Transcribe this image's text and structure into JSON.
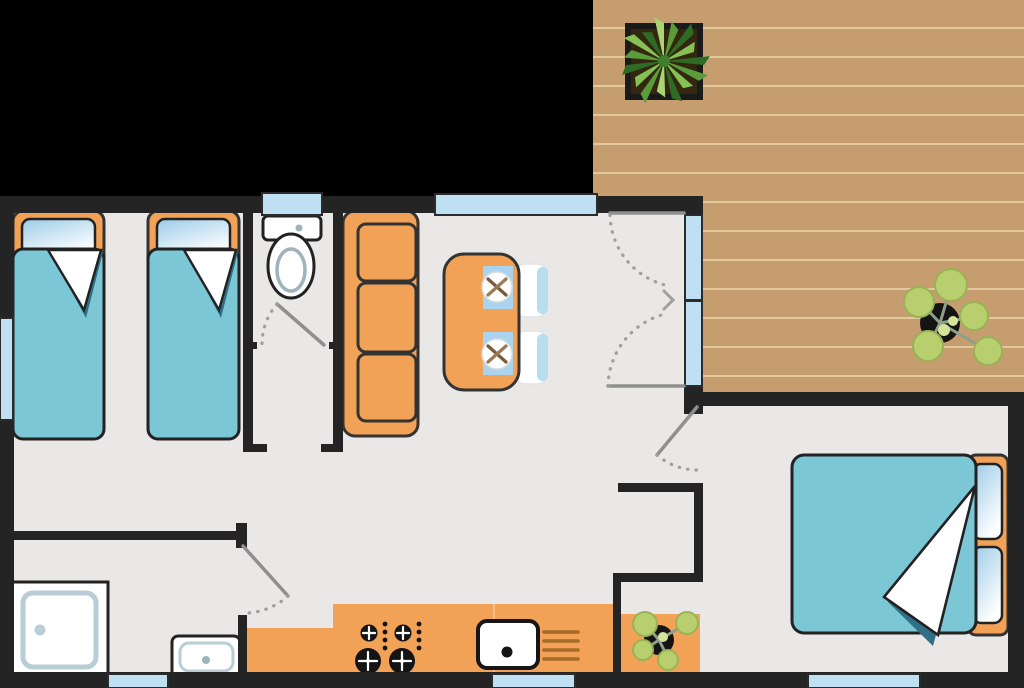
{
  "scene": {
    "type": "floor-plan",
    "title": "Mobile home floor plan with wooden deck, top-down view",
    "view": "top-down 2D architectural plan, no text labels visible"
  },
  "colors": {
    "bg": "#000000",
    "wall": "#242424",
    "floor": "#e9e8e6",
    "deck": "#c69d6e",
    "deck_line": "#e3c99e",
    "accent_orange": "#f1a257",
    "textile_teal": "#7cc7d6",
    "teal_shadow": "#2f7086",
    "window_blue": "#bfe0f3",
    "placemat_blue": "#a9d3ee",
    "chair_blue": "#b8dcf0",
    "fixture_gray": "#b9cdd6",
    "door_line": "#8f8f8f",
    "leaf_green": "#b7cf6e",
    "pot_dark": "#141414",
    "rack_brown": "#a56b28"
  },
  "rooms": [
    {
      "id": "twin-bedroom",
      "label": "Twin bedroom",
      "position": "left",
      "furniture": [
        "single bed x2 with teal blanket and folded corner",
        "side window"
      ]
    },
    {
      "id": "wc",
      "label": "WC",
      "position": "top middle-left",
      "furniture": [
        "toilet",
        "small top window",
        "hinged door"
      ]
    },
    {
      "id": "shower-room",
      "label": "Shower room",
      "position": "bottom left",
      "furniture": [
        "shower tray",
        "washbasin",
        "bottom window",
        "hinged door"
      ]
    },
    {
      "id": "living-dining",
      "label": "Living / dining room",
      "position": "center",
      "furniture": [
        "3-seat orange sofa",
        "dining table with 2 place settings",
        "2 chairs",
        "top window",
        "double french door to deck"
      ]
    },
    {
      "id": "kitchen",
      "label": "Kitchen",
      "position": "bottom center",
      "furniture": [
        "worktop",
        "4-burner hob",
        "sink",
        "dish rack",
        "bottom window"
      ]
    },
    {
      "id": "double-bedroom",
      "label": "Double bedroom",
      "position": "right",
      "furniture": [
        "double bed with teal blanket",
        "orange dresser with potted plant",
        "bottom window",
        "hinged door"
      ]
    },
    {
      "id": "deck",
      "label": "Wooden deck / terrace",
      "position": "top right",
      "furniture": [
        "square planter with spiky plant",
        "potted round-leaf plant"
      ]
    }
  ],
  "doors": [
    {
      "id": "wc-door",
      "type": "hinged",
      "swing": "into WC"
    },
    {
      "id": "shower-room-door",
      "type": "hinged",
      "swing": "into shower room"
    },
    {
      "id": "bedroom-door",
      "type": "hinged",
      "swing": "into double bedroom"
    },
    {
      "id": "french-door",
      "type": "double glazed",
      "swing": "into living room",
      "leads_to": "deck"
    }
  ],
  "window_count": 8
}
